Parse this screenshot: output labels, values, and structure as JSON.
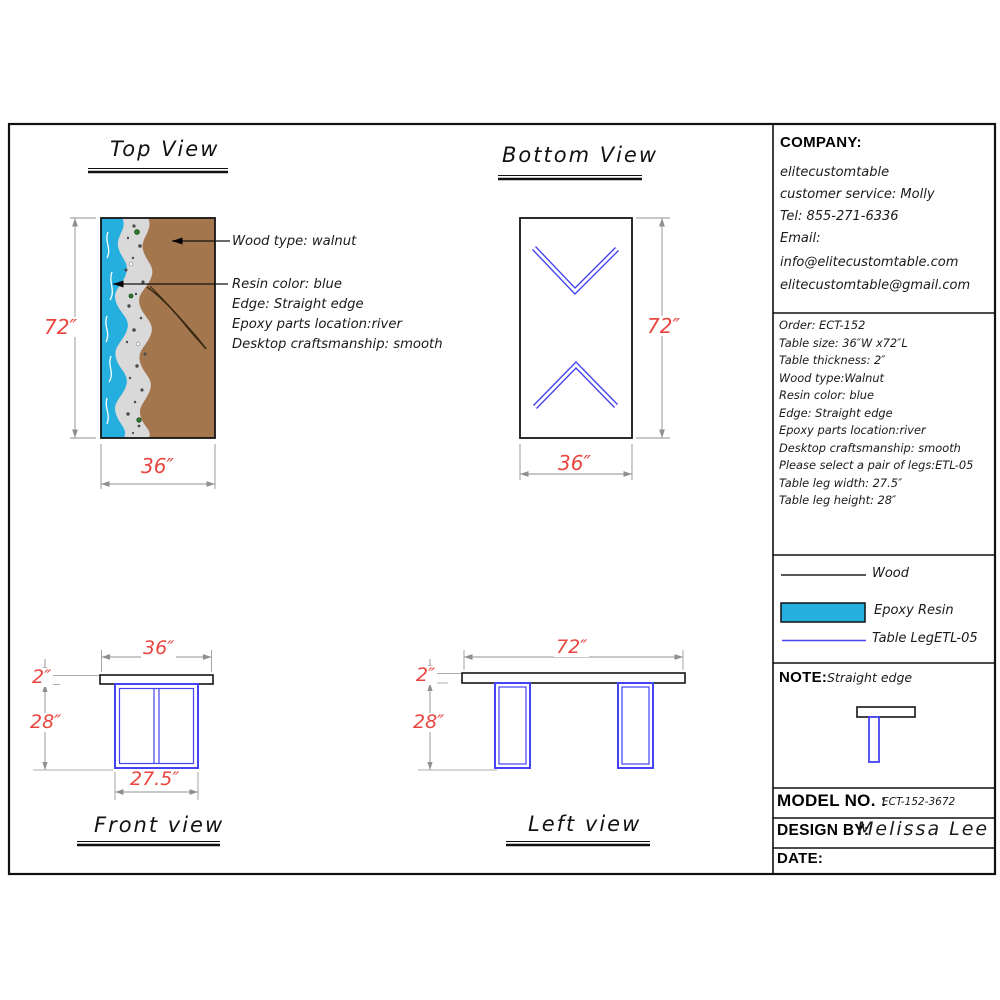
{
  "views": {
    "top": {
      "title": "Top View",
      "dim_length": "72″",
      "dim_width": "36″"
    },
    "bottom": {
      "title": "Bottom View",
      "dim_length": "72″",
      "dim_width": "36″"
    },
    "front": {
      "title": "Front view",
      "dim_width": "36″",
      "dim_thickness": "2″",
      "dim_leg_height": "28″",
      "dim_leg_width": "27.5″"
    },
    "left": {
      "title": "Left view",
      "dim_length": "72″",
      "dim_thickness": "2″",
      "dim_leg_height": "28″"
    }
  },
  "callouts": {
    "wood": "Wood type: walnut",
    "resin": "Resin color: blue",
    "edge": "Edge: Straight edge",
    "epoxy": "Epoxy parts location:river",
    "craftsmanship": "Desktop craftsmanship: smooth"
  },
  "title_block": {
    "company": {
      "label": "COMPANY:",
      "lines": [
        "elitecustomtable",
        "customer service: Molly",
        "Tel: 855-271-6336",
        "Email:",
        "info@elitecustomtable.com",
        "elitecustomtable@gmail.com"
      ]
    },
    "order": {
      "lines": [
        "Order: ECT-152",
        "Table size: 36″W x72″L",
        "Table thickness: 2″",
        "Wood type:Walnut",
        "Resin color: blue",
        "Edge: Straight edge",
        "Epoxy parts location:river",
        "Desktop craftsmanship: smooth",
        "Please select a pair of legs:ETL-05",
        "Table leg width: 27.5″",
        "Table leg height: 28″"
      ]
    },
    "legend": {
      "items": [
        {
          "label": "Wood"
        },
        {
          "label": "Epoxy Resin"
        },
        {
          "label": "Table LegETL-05"
        }
      ]
    },
    "note": {
      "label": "NOTE:",
      "value": "Straight edge"
    },
    "model": {
      "label": "MODEL NO. :",
      "value": "ECT-152-3672"
    },
    "design": {
      "label": "DESIGN BY:",
      "value": "Melissa Lee"
    },
    "date": {
      "label": "DATE:",
      "value": ""
    }
  },
  "colors": {
    "dimension_text": "#e8453f",
    "dimension_line": "#8f8f8f",
    "epoxy_resin": "#24afdf",
    "wood": "#a3764d",
    "stone": "#d9d9d9",
    "table_leg_blue": "#4444f2",
    "outline": "#141414"
  }
}
